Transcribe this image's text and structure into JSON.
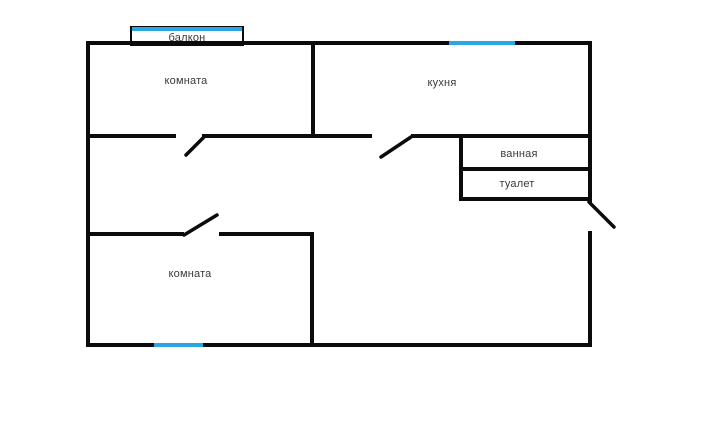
{
  "title": "floor-plan",
  "colors": {
    "wall": "#0b0b0b",
    "window": "#2aa7e0",
    "text": "#3a3a3a",
    "bg": "#ffffff"
  },
  "rooms": {
    "balcony": {
      "label": "балкон"
    },
    "room_top": {
      "label": "комната"
    },
    "kitchen": {
      "label": "кухня"
    },
    "bathroom": {
      "label": "ванная"
    },
    "toilet": {
      "label": "туалет"
    },
    "room_bottom": {
      "label": "комната"
    }
  }
}
